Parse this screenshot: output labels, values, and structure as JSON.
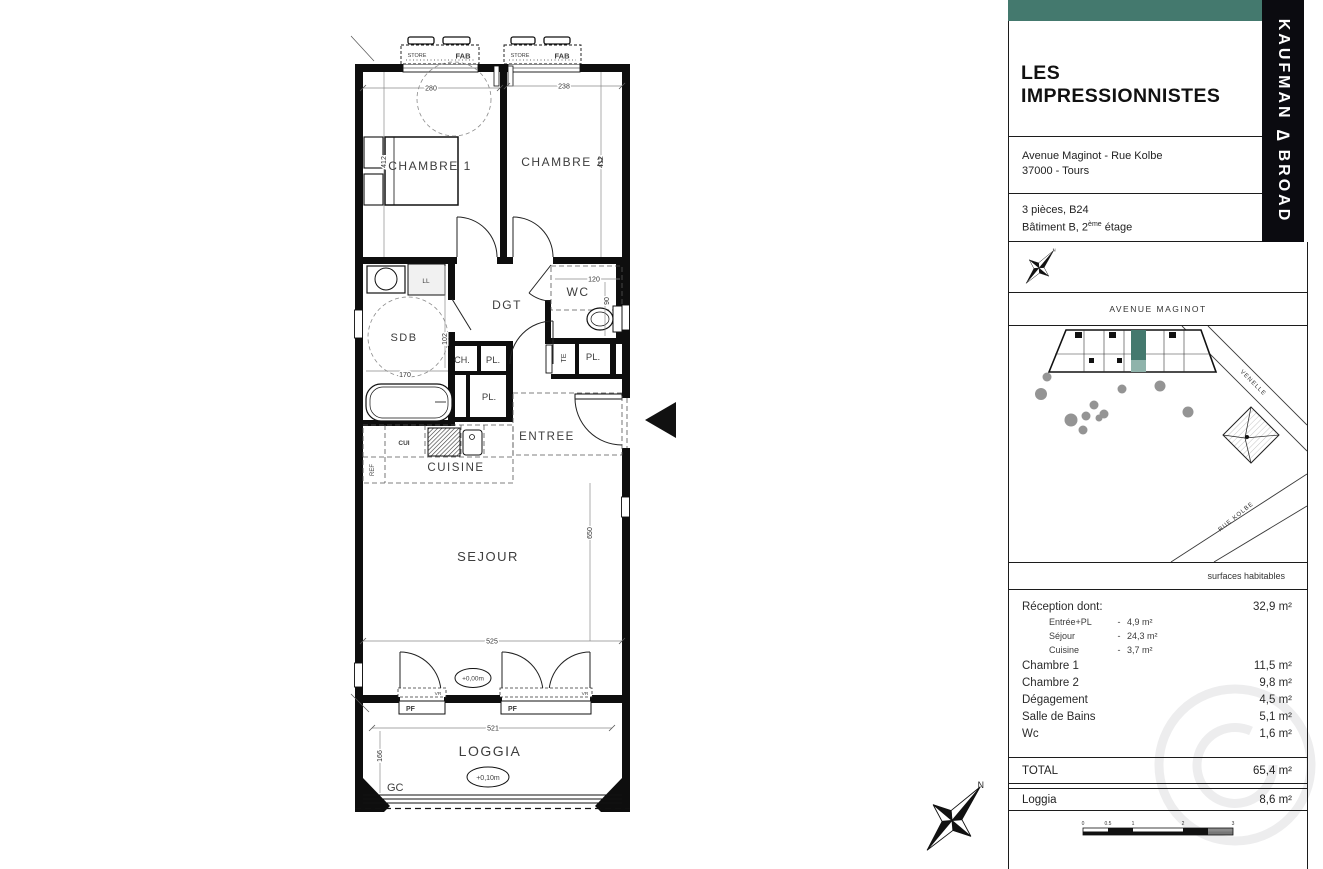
{
  "panel": {
    "accent_color": "#44796e",
    "title": "LES IMPRESSIONNISTES",
    "address_line1": "Avenue Maginot - Rue Kolbe",
    "address_line2": "37000 - Tours",
    "unit_line1": "3 pièces, B24",
    "unit_line2_prefix": "Bâtiment B, 2",
    "unit_line2_sup": "ème",
    "unit_line2_suffix": " étage",
    "brand": {
      "left": "KAUFMAN",
      "mark": "∆",
      "right": "BROAD"
    }
  },
  "site_map": {
    "street_top": "AVENUE MAGINOT",
    "street_right": "VENELLE",
    "street_bottom": "RUE KOLBE",
    "north_label": "N"
  },
  "surfaces": {
    "header": "surfaces habitables",
    "rows": [
      {
        "label": "Réception dont:",
        "value": "32,9 m²"
      },
      {
        "label": "Chambre 1",
        "value": "11,5 m²"
      },
      {
        "label": "Chambre 2",
        "value": "9,8 m²"
      },
      {
        "label": "Dégagement",
        "value": "4,5 m²"
      },
      {
        "label": "Salle de Bains",
        "value": "5,1 m²"
      },
      {
        "label": "Wc",
        "value": "1,6 m²"
      }
    ],
    "sub_rows": [
      {
        "label": "Entrée+PL",
        "sep": "-",
        "value": "4,9 m²"
      },
      {
        "label": "Séjour",
        "sep": "-",
        "value": "24,3 m²"
      },
      {
        "label": "Cuisine",
        "sep": "-",
        "value": "3,7 m²"
      }
    ],
    "total": {
      "label": "TOTAL",
      "value": "65,4 m²"
    },
    "loggia": {
      "label": "Loggia",
      "value": "8,6 m²"
    }
  },
  "scale_bar": {
    "ticks": [
      "0",
      "0.5",
      "1",
      "2",
      "3"
    ]
  },
  "plan": {
    "rooms": {
      "chambre1": "CHAMBRE 1",
      "chambre2": "CHAMBRE 2",
      "dgt": "DGT",
      "wc": "WC",
      "sdb": "SDB",
      "entree": "ENTREE",
      "cuisine": "CUISINE",
      "sejour": "SEJOUR",
      "loggia": "LOGGIA"
    },
    "labels": {
      "store": "STORE",
      "fab": "FAB",
      "ll": "LL",
      "cui": "CUI",
      "ref": "REF",
      "te": "TE",
      "ch": "CH.",
      "pl": "PL.",
      "pf": "PF",
      "vr": "VR",
      "gc": "GC"
    },
    "levels": {
      "sejour": "+0,00m",
      "loggia": "+0,10m"
    },
    "dims": {
      "chambre1_w": "280",
      "chambre2_w": "238",
      "chambre1_h": "412",
      "chambre2_h": "412",
      "wc_w": "120",
      "wc_h": "90",
      "sdb_w": "170",
      "sdb_h": "102",
      "sejour_w": "525",
      "sejour_h": "650",
      "loggia_w": "521",
      "loggia_h": "166"
    }
  }
}
